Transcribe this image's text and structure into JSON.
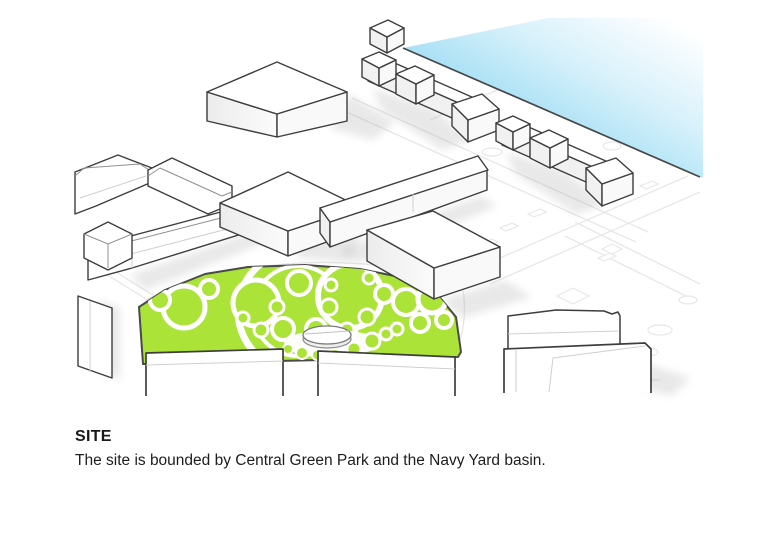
{
  "caption": {
    "title": "SITE",
    "description": "The site is bounded by Central Green Park and the Navy Yard basin."
  },
  "diagram": {
    "type": "axonometric-site-plan",
    "regions": {
      "park": "Central Green Park",
      "water": "Navy Yard basin",
      "buildings": "site and context buildings"
    },
    "colors": {
      "park_green": "#abe339",
      "water_blue": "#7fd2f0",
      "building_fill": "#ffffff",
      "building_outline": "#3d3d3d",
      "ground_line": "#e7e7e7",
      "text": "#191919"
    }
  }
}
